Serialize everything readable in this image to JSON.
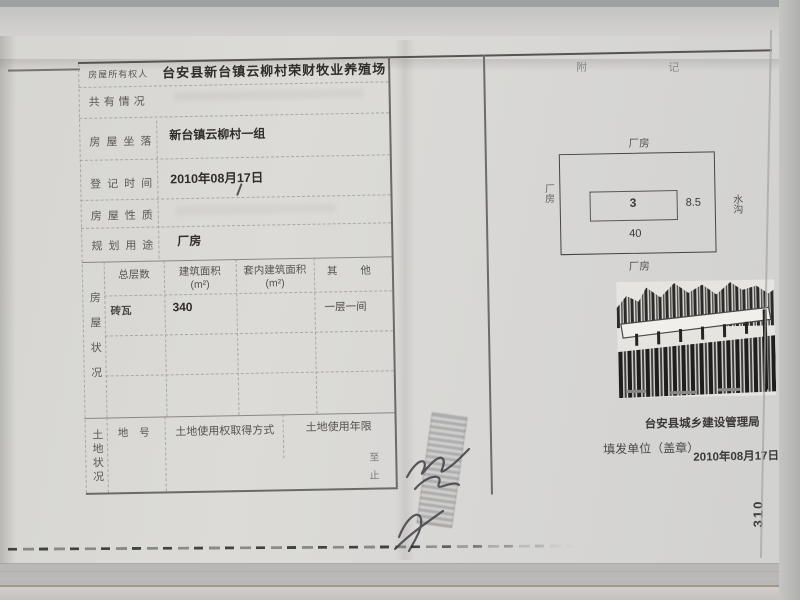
{
  "form": {
    "rows": [
      {
        "label": "房屋所有权人",
        "value": "台安县新台镇云柳村荣财牧业养殖场"
      },
      {
        "label": "共有情况",
        "value": ""
      },
      {
        "label": "房屋坐落",
        "value": "新台镇云柳村一组"
      },
      {
        "label": "登记时间",
        "value": "2010年08月17日"
      },
      {
        "label": "房屋性质",
        "value": ""
      },
      {
        "label": "规划用途",
        "value": "厂房"
      }
    ],
    "house": {
      "side_label": "房屋状况",
      "headers": [
        {
          "t": "总层数",
          "u": ""
        },
        {
          "t": "建筑面积",
          "u": "(m²)"
        },
        {
          "t": "套内建筑面积",
          "u": "(m²)"
        },
        {
          "t": "其 他",
          "u": ""
        }
      ],
      "row": {
        "structure": "砖瓦",
        "area": "340",
        "inner_area": "",
        "other": "一层一间"
      }
    },
    "land": {
      "side_label": "土地状况",
      "headers": [
        "地 号",
        "土地使用权取得方式",
        "土地使用年限"
      ],
      "marks": {
        "from": "至",
        "to": "止"
      }
    }
  },
  "notes": {
    "title_left": "附",
    "title_right": "记",
    "diagram": {
      "top": "厂房",
      "bottom": "厂房",
      "left": "厂房",
      "right": "水沟",
      "inner": "3",
      "width": "40",
      "height": "8.5"
    },
    "issuer": "台安县城乡建设管理局",
    "issue_label": "填发单位（盖章）",
    "issue_date": "2010年08月17日"
  },
  "page_number": "310",
  "colors": {
    "ink": "#2f2e2b",
    "print": "#5a5955",
    "line": "#55544f"
  }
}
